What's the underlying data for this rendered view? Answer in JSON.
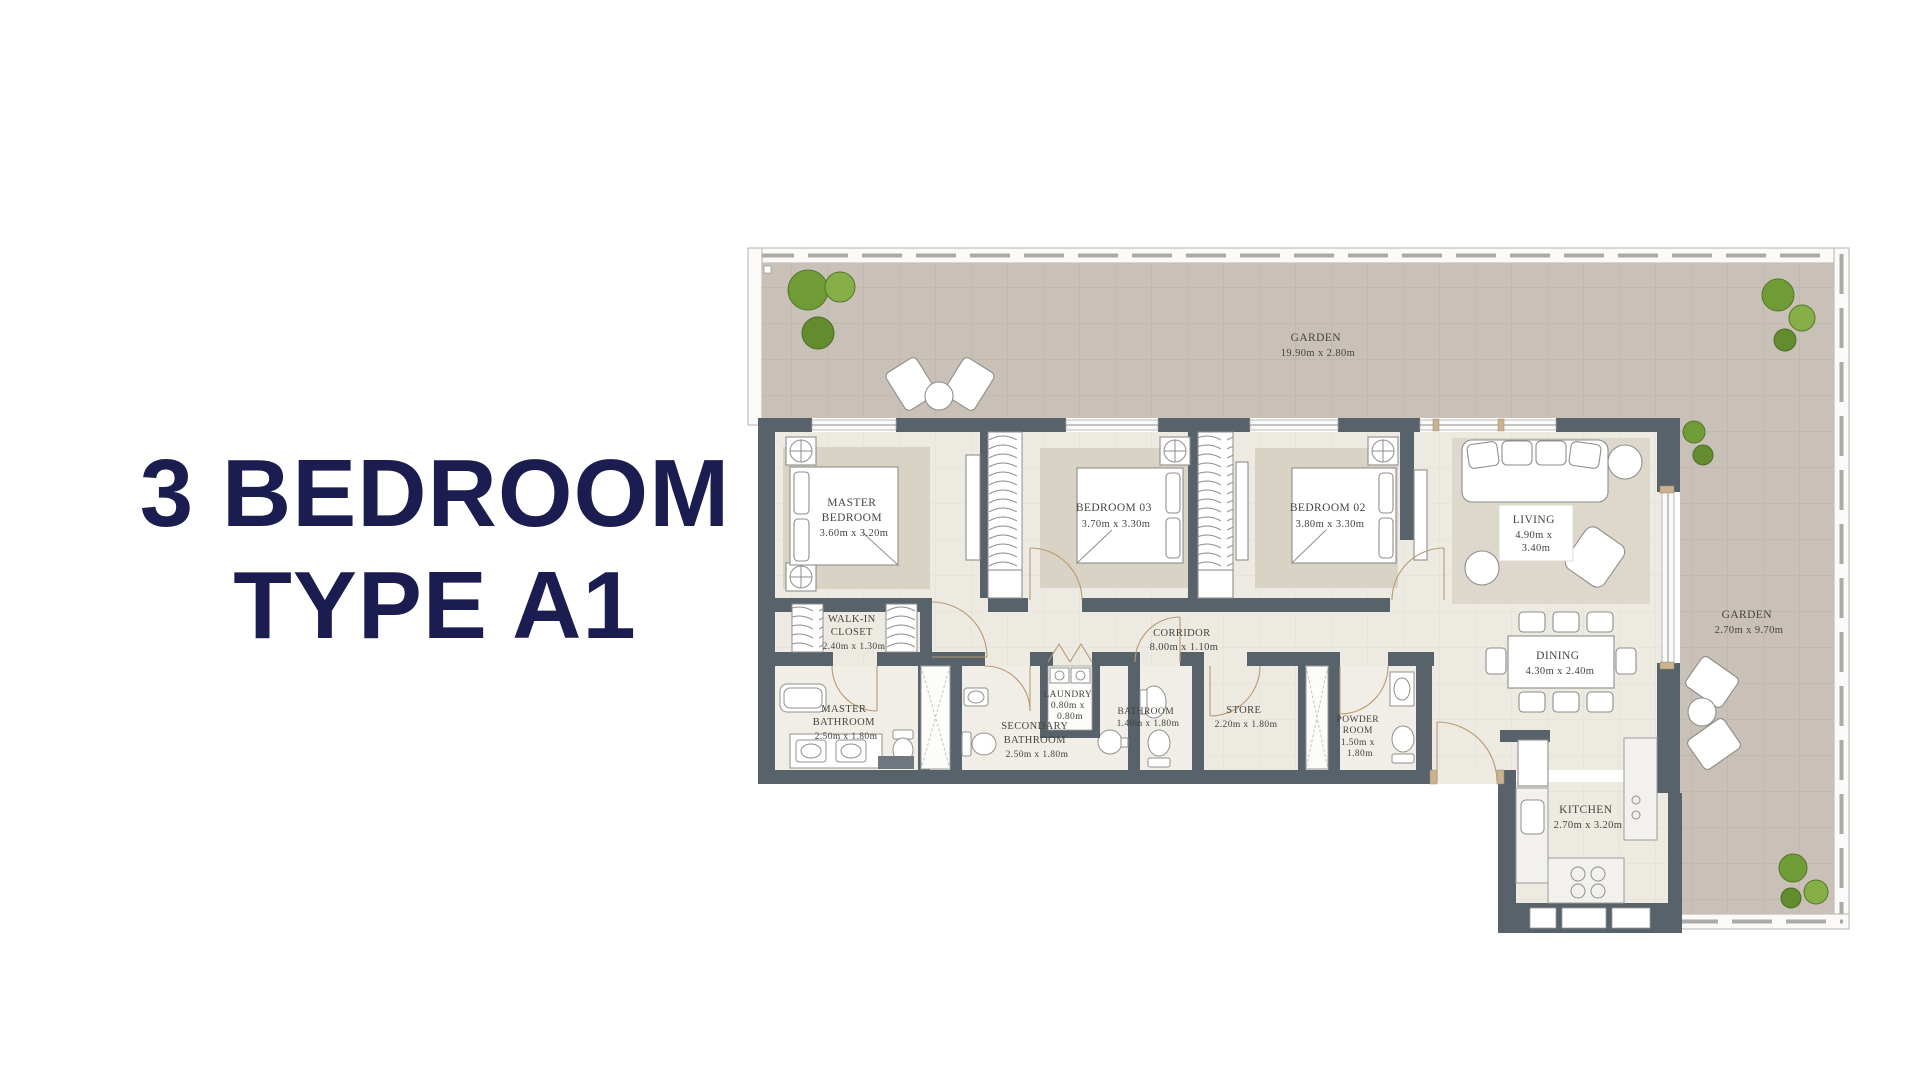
{
  "title": {
    "line1": "3 BEDROOM",
    "line2": "TYPE A1"
  },
  "colors": {
    "title_navy": "#1b1c4f",
    "wall_gray": "#57626a",
    "garden_taupe": "#c9c0b7",
    "floor_beige": "#edeae2",
    "carpet_beige": "#d9d3c6",
    "tree_green": "#74a03a",
    "door_tan": "#b99a72"
  },
  "plan": {
    "garden_top": {
      "lines": [
        "GARDEN",
        "19.90m x 2.80m"
      ]
    },
    "garden_right": {
      "lines": [
        "GARDEN",
        "2.70m x 9.70m"
      ]
    },
    "master_bedroom": {
      "lines": [
        "MASTER",
        "BEDROOM",
        "3.60m x 3.20m"
      ]
    },
    "bedroom_03": {
      "lines": [
        "BEDROOM 03",
        "3.70m x 3.30m"
      ]
    },
    "bedroom_02": {
      "lines": [
        "BEDROOM 02",
        "3.80m x 3.30m"
      ]
    },
    "living": {
      "lines": [
        "LIVING",
        "4.90m x",
        "3.40m"
      ]
    },
    "walk_in_closet": {
      "lines": [
        "WALK-IN",
        "CLOSET",
        "2.40m x 1.30m"
      ]
    },
    "corridor": {
      "lines": [
        "CORRIDOR",
        "8.00m x 1.10m"
      ]
    },
    "master_bathroom": {
      "lines": [
        "MASTER",
        "BATHROOM",
        "2.50m x 1.80m"
      ]
    },
    "secondary_bathroom": {
      "lines": [
        "SECONDARY",
        "BATHROOM",
        "2.50m x 1.80m"
      ]
    },
    "laundry": {
      "lines": [
        "LAUNDRY",
        "0.80m x",
        "0.80m"
      ]
    },
    "bathroom": {
      "lines": [
        "BATHROOM",
        "1.40m x 1.80m"
      ]
    },
    "store": {
      "lines": [
        "STORE",
        "2.20m x 1.80m"
      ]
    },
    "powder_room": {
      "lines": [
        "POWDER",
        "ROOM",
        "1.50m x",
        "1.80m"
      ]
    },
    "dining": {
      "lines": [
        "DINING",
        "4.30m x 2.40m"
      ]
    },
    "kitchen": {
      "lines": [
        "KITCHEN",
        "2.70m x 3.20m"
      ]
    }
  }
}
